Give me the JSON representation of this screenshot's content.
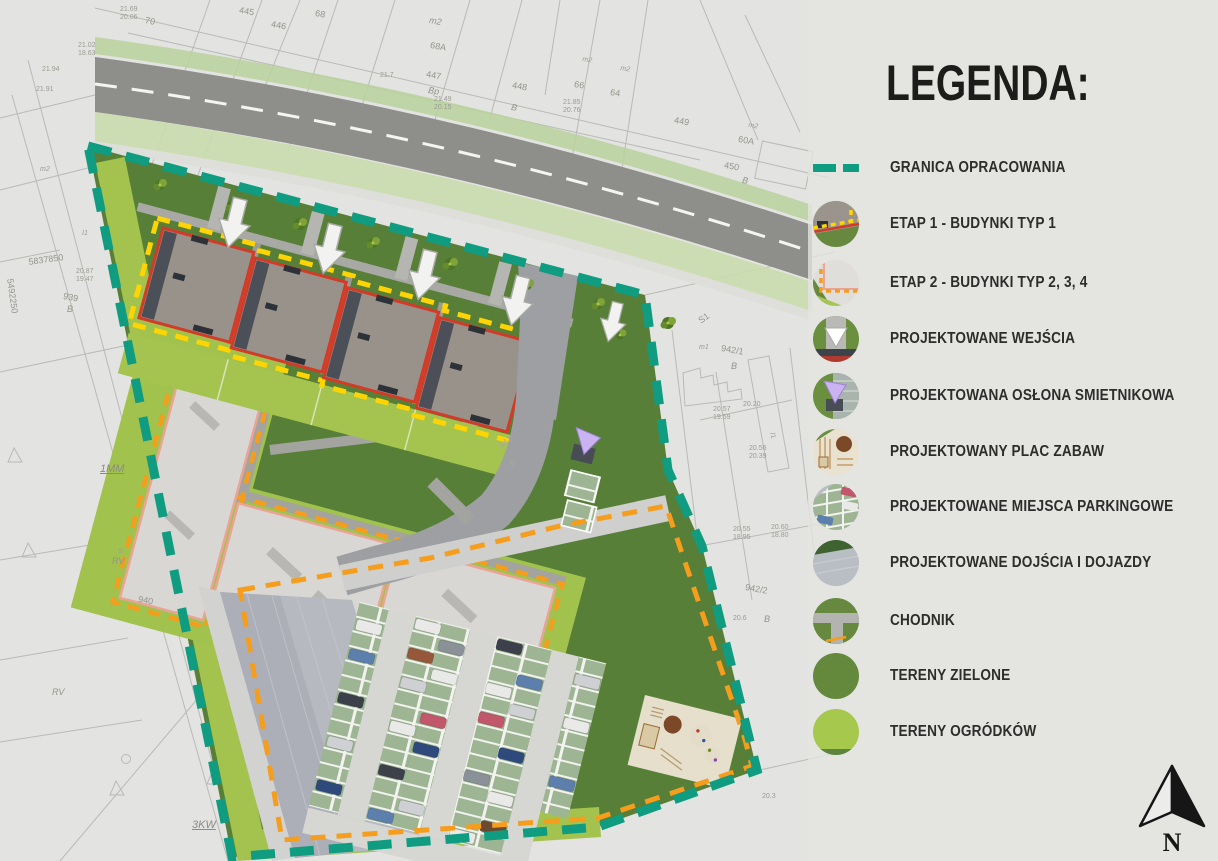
{
  "legend": {
    "title": "LEGENDA:",
    "items": [
      {
        "label": "GRANICA OPRACOWANIA",
        "icon": "teal-dash-swatch"
      },
      {
        "label": "ETAP 1 - BUDYNKI TYP 1",
        "icon": "stage1-building-swatch"
      },
      {
        "label": "ETAP 2 - BUDYNKI TYP 2, 3, 4",
        "icon": "stage2-building-swatch"
      },
      {
        "label": "PROJEKTOWANE WEJŚCIA",
        "icon": "entrance-arrow-swatch"
      },
      {
        "label": "PROJEKTOWANA OSŁONA SMIETNIKOWA",
        "icon": "trash-shelter-swatch"
      },
      {
        "label": "PROJEKTOWANY PLAC ZABAW",
        "icon": "playground-swatch"
      },
      {
        "label": "PROJEKTOWANE MIEJSCA PARKINGOWE",
        "icon": "parking-swatch"
      },
      {
        "label": "PROJEKTOWANE DOJŚCIA I DOJAZDY",
        "icon": "pavement-swatch"
      },
      {
        "label": "CHODNIK",
        "icon": "sidewalk-swatch"
      },
      {
        "label": "TERENY ZIELONE",
        "icon": "green-area-swatch"
      },
      {
        "label": "TERENY OGRÓDKÓW",
        "icon": "garden-area-swatch"
      }
    ]
  },
  "compass": {
    "label": "N"
  },
  "colors": {
    "boundary_teal": "#0f9c80",
    "stage1_outline_red": "#d23b27",
    "stage1_dash_yellow": "#ffd400",
    "stage2_dash_orange": "#f59d1d",
    "green_area": "#577f37",
    "garden_lime": "#a3c24e"
  },
  "map_labels": [
    {
      "text": "70"
    },
    {
      "text": "445"
    },
    {
      "text": "446"
    },
    {
      "text": "68"
    },
    {
      "text": "m2"
    },
    {
      "text": "68A"
    },
    {
      "text": "447"
    },
    {
      "text": "Bp"
    },
    {
      "text": "448"
    },
    {
      "text": "B"
    },
    {
      "text": "66"
    },
    {
      "text": "64"
    },
    {
      "text": "m2"
    },
    {
      "text": "m2"
    },
    {
      "text": "449"
    },
    {
      "text": "m2"
    },
    {
      "text": "60A"
    },
    {
      "text": "450"
    },
    {
      "text": "B"
    },
    {
      "text": "21.7"
    },
    {
      "text": "21.85"
    },
    {
      "text": "20.76"
    },
    {
      "text": "21.49"
    },
    {
      "text": "20.15"
    },
    {
      "text": "21.69"
    },
    {
      "text": "20.06"
    },
    {
      "text": "21.02"
    },
    {
      "text": "18.63"
    },
    {
      "text": "21.94"
    },
    {
      "text": "21.91"
    },
    {
      "text": "5837850"
    },
    {
      "text": "5492250"
    },
    {
      "text": "939"
    },
    {
      "text": "B"
    },
    {
      "text": "20.87"
    },
    {
      "text": "19.47"
    },
    {
      "text": "1MM"
    },
    {
      "text": "S"
    },
    {
      "text": "RV"
    },
    {
      "text": "940"
    },
    {
      "text": "RV"
    },
    {
      "text": "3KW"
    },
    {
      "text": "I1"
    },
    {
      "text": "S1"
    },
    {
      "text": "m1"
    },
    {
      "text": "942/1"
    },
    {
      "text": "B"
    },
    {
      "text": "/1"
    },
    {
      "text": "942/2"
    },
    {
      "text": "B"
    },
    {
      "text": "20.20"
    },
    {
      "text": "20.57"
    },
    {
      "text": "19.59"
    },
    {
      "text": "20.56"
    },
    {
      "text": "20.39"
    },
    {
      "text": "20.55"
    },
    {
      "text": "18.95"
    },
    {
      "text": "20.60"
    },
    {
      "text": "18.80"
    },
    {
      "text": "20.6"
    },
    {
      "text": "20.3"
    },
    {
      "text": "m2"
    },
    {
      "text": "941"
    },
    {
      "text": "B"
    }
  ]
}
